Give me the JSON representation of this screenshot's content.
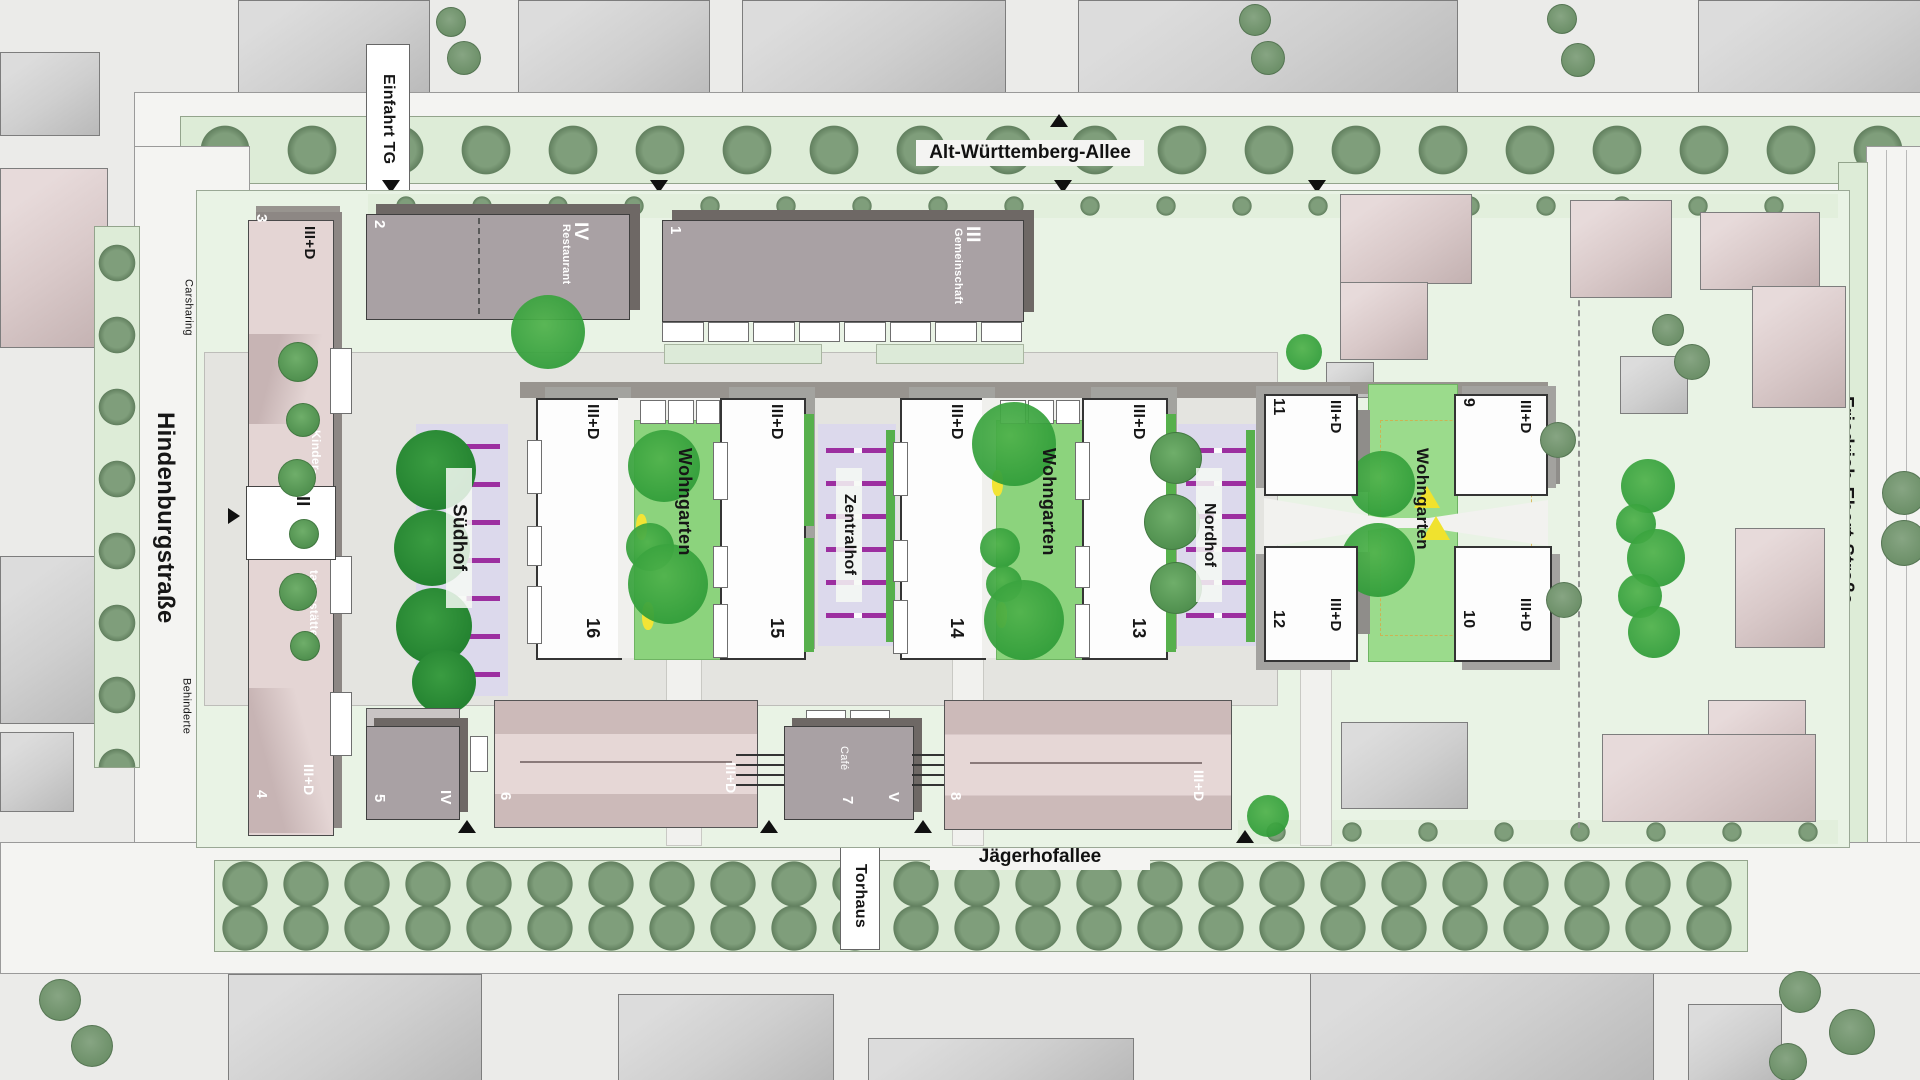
{
  "streets": {
    "top": "Alt-Württemberg-Allee",
    "left": "Hindenburgstraße",
    "right": "Friedrich-Ebert-Straße",
    "bottom": "Jägerhofallee"
  },
  "labels": {
    "einfahrt_tg": "Einfahrt TG",
    "carsharing": "Carsharing",
    "vorfahrt_kita": "Vorfahrt KITA",
    "behinderte": "Behinderte",
    "torhaus": "Torhaus"
  },
  "courtyards": {
    "suedhof": "Südhof",
    "zentralhof": "Zentralhof",
    "nordhof": "Nordhof",
    "wohngarten_west": "Wohngarten",
    "wohngarten_mitte": "Wohngarten",
    "wohngarten_ost": "Wohngarten"
  },
  "buildings": {
    "b1": {
      "num": "1",
      "floors": "III",
      "use": "Gemeinschaft"
    },
    "b2": {
      "num": "2",
      "floors": "IV",
      "use": "Restaurant"
    },
    "b3": {
      "num": "3",
      "floors": "III+D",
      "use1": "Kinder-",
      "use2": "tagesstätte"
    },
    "b4": {
      "num": "4",
      "floors": "III+D"
    },
    "b5": {
      "num": "5",
      "floors": "IV"
    },
    "b6": {
      "num": "6",
      "floors": "III+D"
    },
    "b7": {
      "num": "7",
      "floors": "V",
      "use": "Café"
    },
    "b8": {
      "num": "8",
      "floors": "III+D"
    },
    "b9": {
      "num": "9",
      "floors": "III+D"
    },
    "b10": {
      "num": "10",
      "floors": "III+D"
    },
    "b11": {
      "num": "11",
      "floors": "III+D"
    },
    "b12": {
      "num": "12",
      "floors": "III+D"
    },
    "b13": {
      "num": "13",
      "floors": "III+D"
    },
    "b14": {
      "num": "14",
      "floors": "III+D"
    },
    "b15": {
      "num": "15",
      "floors": "III+D"
    },
    "b16": {
      "num": "16",
      "floors": "III+D"
    },
    "kita_entrance": "II"
  },
  "colors": {
    "site_green": "#e9f3e5",
    "street_green": "#ddecd7",
    "tree_sage": "#7f9e7b",
    "tree_bright": "#2f9c38",
    "garden_green": "#8cd37d",
    "court_lavender": "#dcd9ec",
    "stripe_purple": "#9c2fa0",
    "building_gray": "#a9a1a4",
    "building_pink": "#e4d5d4",
    "accent_yellow": "#f2e435"
  }
}
